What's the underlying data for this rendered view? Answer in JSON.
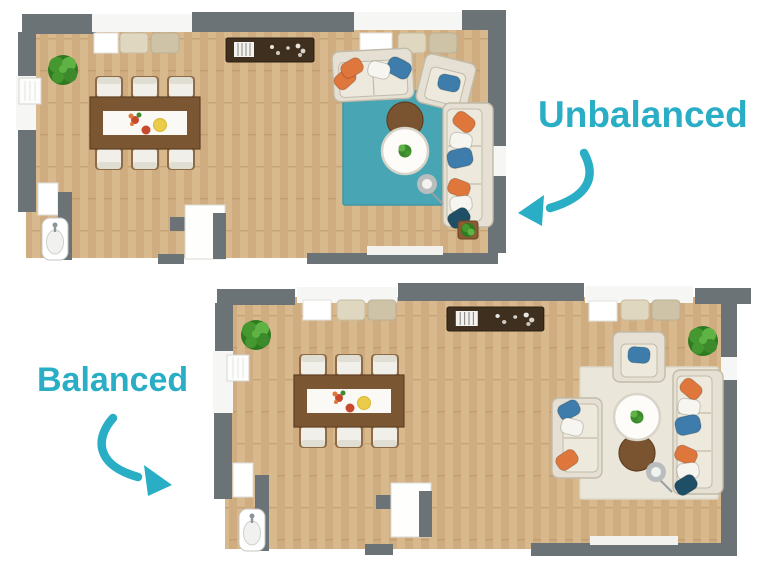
{
  "labels": {
    "unbalanced": "Unbalanced",
    "balanced": "Balanced"
  },
  "colors": {
    "accent": "#2AAEC5",
    "wall": "#6C7376",
    "floor": "#D8B88D",
    "floor_stripe": "#C8A276",
    "floor_joint": "#B08A5C",
    "room_white": "#F6F6F4",
    "curtain": "#E0D7C0",
    "curtain2": "#CEC3A7",
    "sofa": "#E5E0D3",
    "sofa_edge": "#C2BBAA",
    "sofa_seat": "#EDE9DC",
    "pillow_orange": "#DF763B",
    "pillow_blue": "#3D7CAB",
    "pillow_navy": "#1F4F66",
    "pillow_white": "#F7F5EF",
    "rug_teal": "#48A5B3",
    "rug_cream": "#EAE6DA",
    "table_wood": "#7B5632",
    "table_wood_dark": "#5E3F22",
    "runner": "#FAF9F5",
    "table_top": "#FDFCF8",
    "sideboard": "#3F2F1E",
    "ottoman": "#7A5430",
    "plant": "#45982F",
    "plant2": "#5FB344",
    "plant_dark": "#2E7A20",
    "plant_dark2": "#3C8A2C",
    "lamp": "#B9BDBE",
    "chair": "#F1EFE9",
    "chair_back": "#E0DDD3",
    "chair_wood": "#8E6B44",
    "decor_red": "#C84A2E",
    "decor_yellow": "#EACB4A"
  },
  "plans": {
    "unbalanced": {
      "name": "Unbalanced floor plan",
      "rug": "teal",
      "furniture": [
        "potted-plant",
        "dining-table",
        "dining-chairs-x6",
        "sideboard",
        "window-curtains-x2",
        "loveseat",
        "armchair",
        "three-seat-sofa",
        "throw-pillows-orange-blue-white",
        "teal-area-rug",
        "round-coffee-table",
        "round-ottoman",
        "floor-lamp",
        "plant-side-table",
        "kitchen-sink",
        "radiator",
        "door"
      ]
    },
    "balanced": {
      "name": "Balanced floor plan",
      "rug": "cream",
      "furniture": [
        "potted-plant-x2",
        "dining-table",
        "dining-chairs-x6",
        "sideboard",
        "window-curtains-x2",
        "loveseat",
        "armchair",
        "three-seat-sofa",
        "throw-pillows-orange-blue-white",
        "cream-area-rug",
        "round-coffee-table",
        "round-ottoman",
        "floor-lamp",
        "kitchen-sink",
        "radiator",
        "door"
      ]
    }
  }
}
